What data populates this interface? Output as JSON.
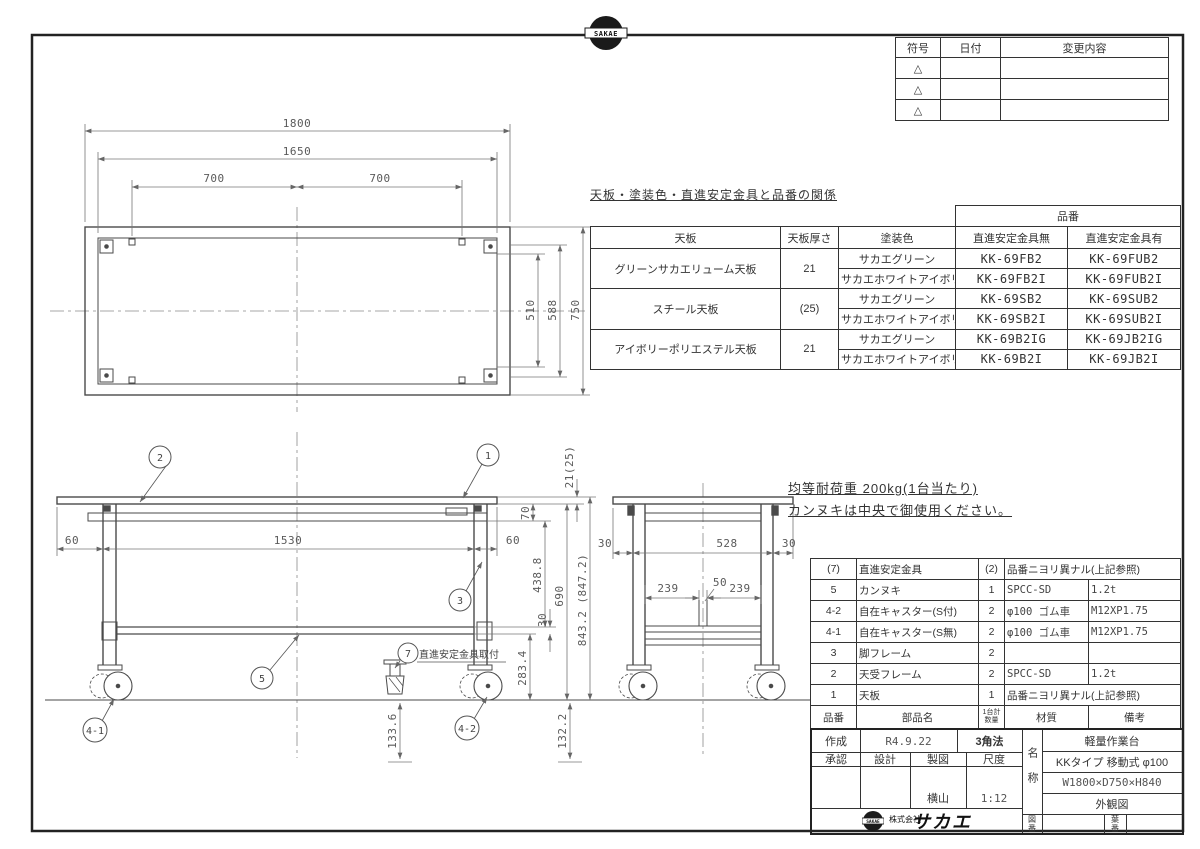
{
  "drawing": {
    "company_logo_text": "SAKAE",
    "company_name_small": "株式会社",
    "company_name_big": "サカエ"
  },
  "revision_table": {
    "headers": {
      "symbol": "符号",
      "date": "日付",
      "change": "変更内容"
    },
    "rows": [
      {
        "symbol": "△"
      },
      {
        "symbol": "△"
      },
      {
        "symbol": "△"
      }
    ]
  },
  "relation_table": {
    "title": "天板・塗装色・直進安定金具と品番の関係",
    "headers": {
      "top_board": "天板",
      "thickness": "天板厚さ",
      "paint_color": "塗装色",
      "part_no": "品番",
      "without": "直進安定金具無",
      "with": "直進安定金具有"
    },
    "groups": [
      {
        "top_board": "グリーンサカエリューム天板",
        "thickness": "21",
        "rows": [
          {
            "color": "サカエグリーン",
            "without": "KK-69FB2",
            "with": "KK-69FUB2"
          },
          {
            "color": "サカエホワイトアイボリー",
            "without": "KK-69FB2I",
            "with": "KK-69FUB2I"
          }
        ]
      },
      {
        "top_board": "スチール天板",
        "thickness": "(25)",
        "rows": [
          {
            "color": "サカエグリーン",
            "without": "KK-69SB2",
            "with": "KK-69SUB2"
          },
          {
            "color": "サカエホワイトアイボリー",
            "without": "KK-69SB2I",
            "with": "KK-69SUB2I"
          }
        ]
      },
      {
        "top_board": "アイボリーポリエステル天板",
        "thickness": "21",
        "rows": [
          {
            "color": "サカエグリーン",
            "without": "KK-69B2IG",
            "with": "KK-69JB2IG"
          },
          {
            "color": "サカエホワイトアイボリー",
            "without": "KK-69B2I",
            "with": "KK-69JB2I"
          }
        ]
      }
    ]
  },
  "notes": {
    "load": "均等耐荷重 200kg(1台当たり)",
    "kannuki": "カンヌキは中央で御使用ください。"
  },
  "plan_view": {
    "dim_1800": "1800",
    "dim_1650": "1650",
    "dim_700_left": "700",
    "dim_700_right": "700",
    "dim_510": "510",
    "dim_588": "588",
    "dim_750": "750"
  },
  "front_view": {
    "dim_60_left": "60",
    "dim_1530": "1530",
    "dim_60_right": "60",
    "dim_21_25": "21(25)",
    "dim_70": "70",
    "dim_438_8": "438.8",
    "dim_690": "690",
    "dim_843": "843.2 (847.2)",
    "dim_30": "30",
    "dim_283_4": "283.4",
    "dim_133_6": "133.6",
    "dim_132_2": "132.2",
    "balloons": {
      "b1": "1",
      "b2": "2",
      "b3": "3",
      "b5": "5",
      "b7": "7",
      "b4_1": "4-1",
      "b4_2": "4-2"
    },
    "balloon7_label": "直進安定金具取付"
  },
  "side_view": {
    "dim_30_left": "30",
    "dim_528": "528",
    "dim_30_right": "30",
    "dim_239_left": "239",
    "dim_50": "50",
    "dim_239_right": "239"
  },
  "parts_table": {
    "headers": {
      "no": "品番",
      "name": "部品名",
      "qty1": "1台計",
      "qty2": "数量",
      "material": "材質",
      "remarks": "備考"
    },
    "rows": [
      {
        "no": "(7)",
        "name": "直進安定金具",
        "qty": "(2)",
        "material": "品番ニヨリ異ナル(上記参照)",
        "remarks": ""
      },
      {
        "no": "5",
        "name": "カンヌキ",
        "qty": "1",
        "material": "SPCC-SD",
        "remarks": "1.2t"
      },
      {
        "no": "4-2",
        "name": "自在キャスター(S付)",
        "qty": "2",
        "material": "φ100 ゴム車",
        "remarks": "M12XP1.75"
      },
      {
        "no": "4-1",
        "name": "自在キャスター(S無)",
        "qty": "2",
        "material": "φ100 ゴム車",
        "remarks": "M12XP1.75"
      },
      {
        "no": "3",
        "name": "脚フレーム",
        "qty": "2",
        "material": "",
        "remarks": ""
      },
      {
        "no": "2",
        "name": "天受フレーム",
        "qty": "2",
        "material": "SPCC-SD",
        "remarks": "1.2t"
      },
      {
        "no": "1",
        "name": "天板",
        "qty": "1",
        "material": "品番ニヨリ異ナル(上記参照)",
        "remarks": ""
      }
    ]
  },
  "title_block": {
    "created_label": "作成",
    "created_date": "R4.9.22",
    "projection": "3角法",
    "approve_label": "承認",
    "design_label": "設計",
    "draft_label": "製図",
    "scale_label": "尺度",
    "drafter": "横山",
    "scale": "1:12",
    "name_label": "名称",
    "name_lines": [
      "軽量作業台",
      "KKタイプ 移動式 φ100",
      "W1800×D750×H840",
      "外観図"
    ],
    "drawing_no_label": "図番",
    "sheet_no_label": "葉番"
  }
}
